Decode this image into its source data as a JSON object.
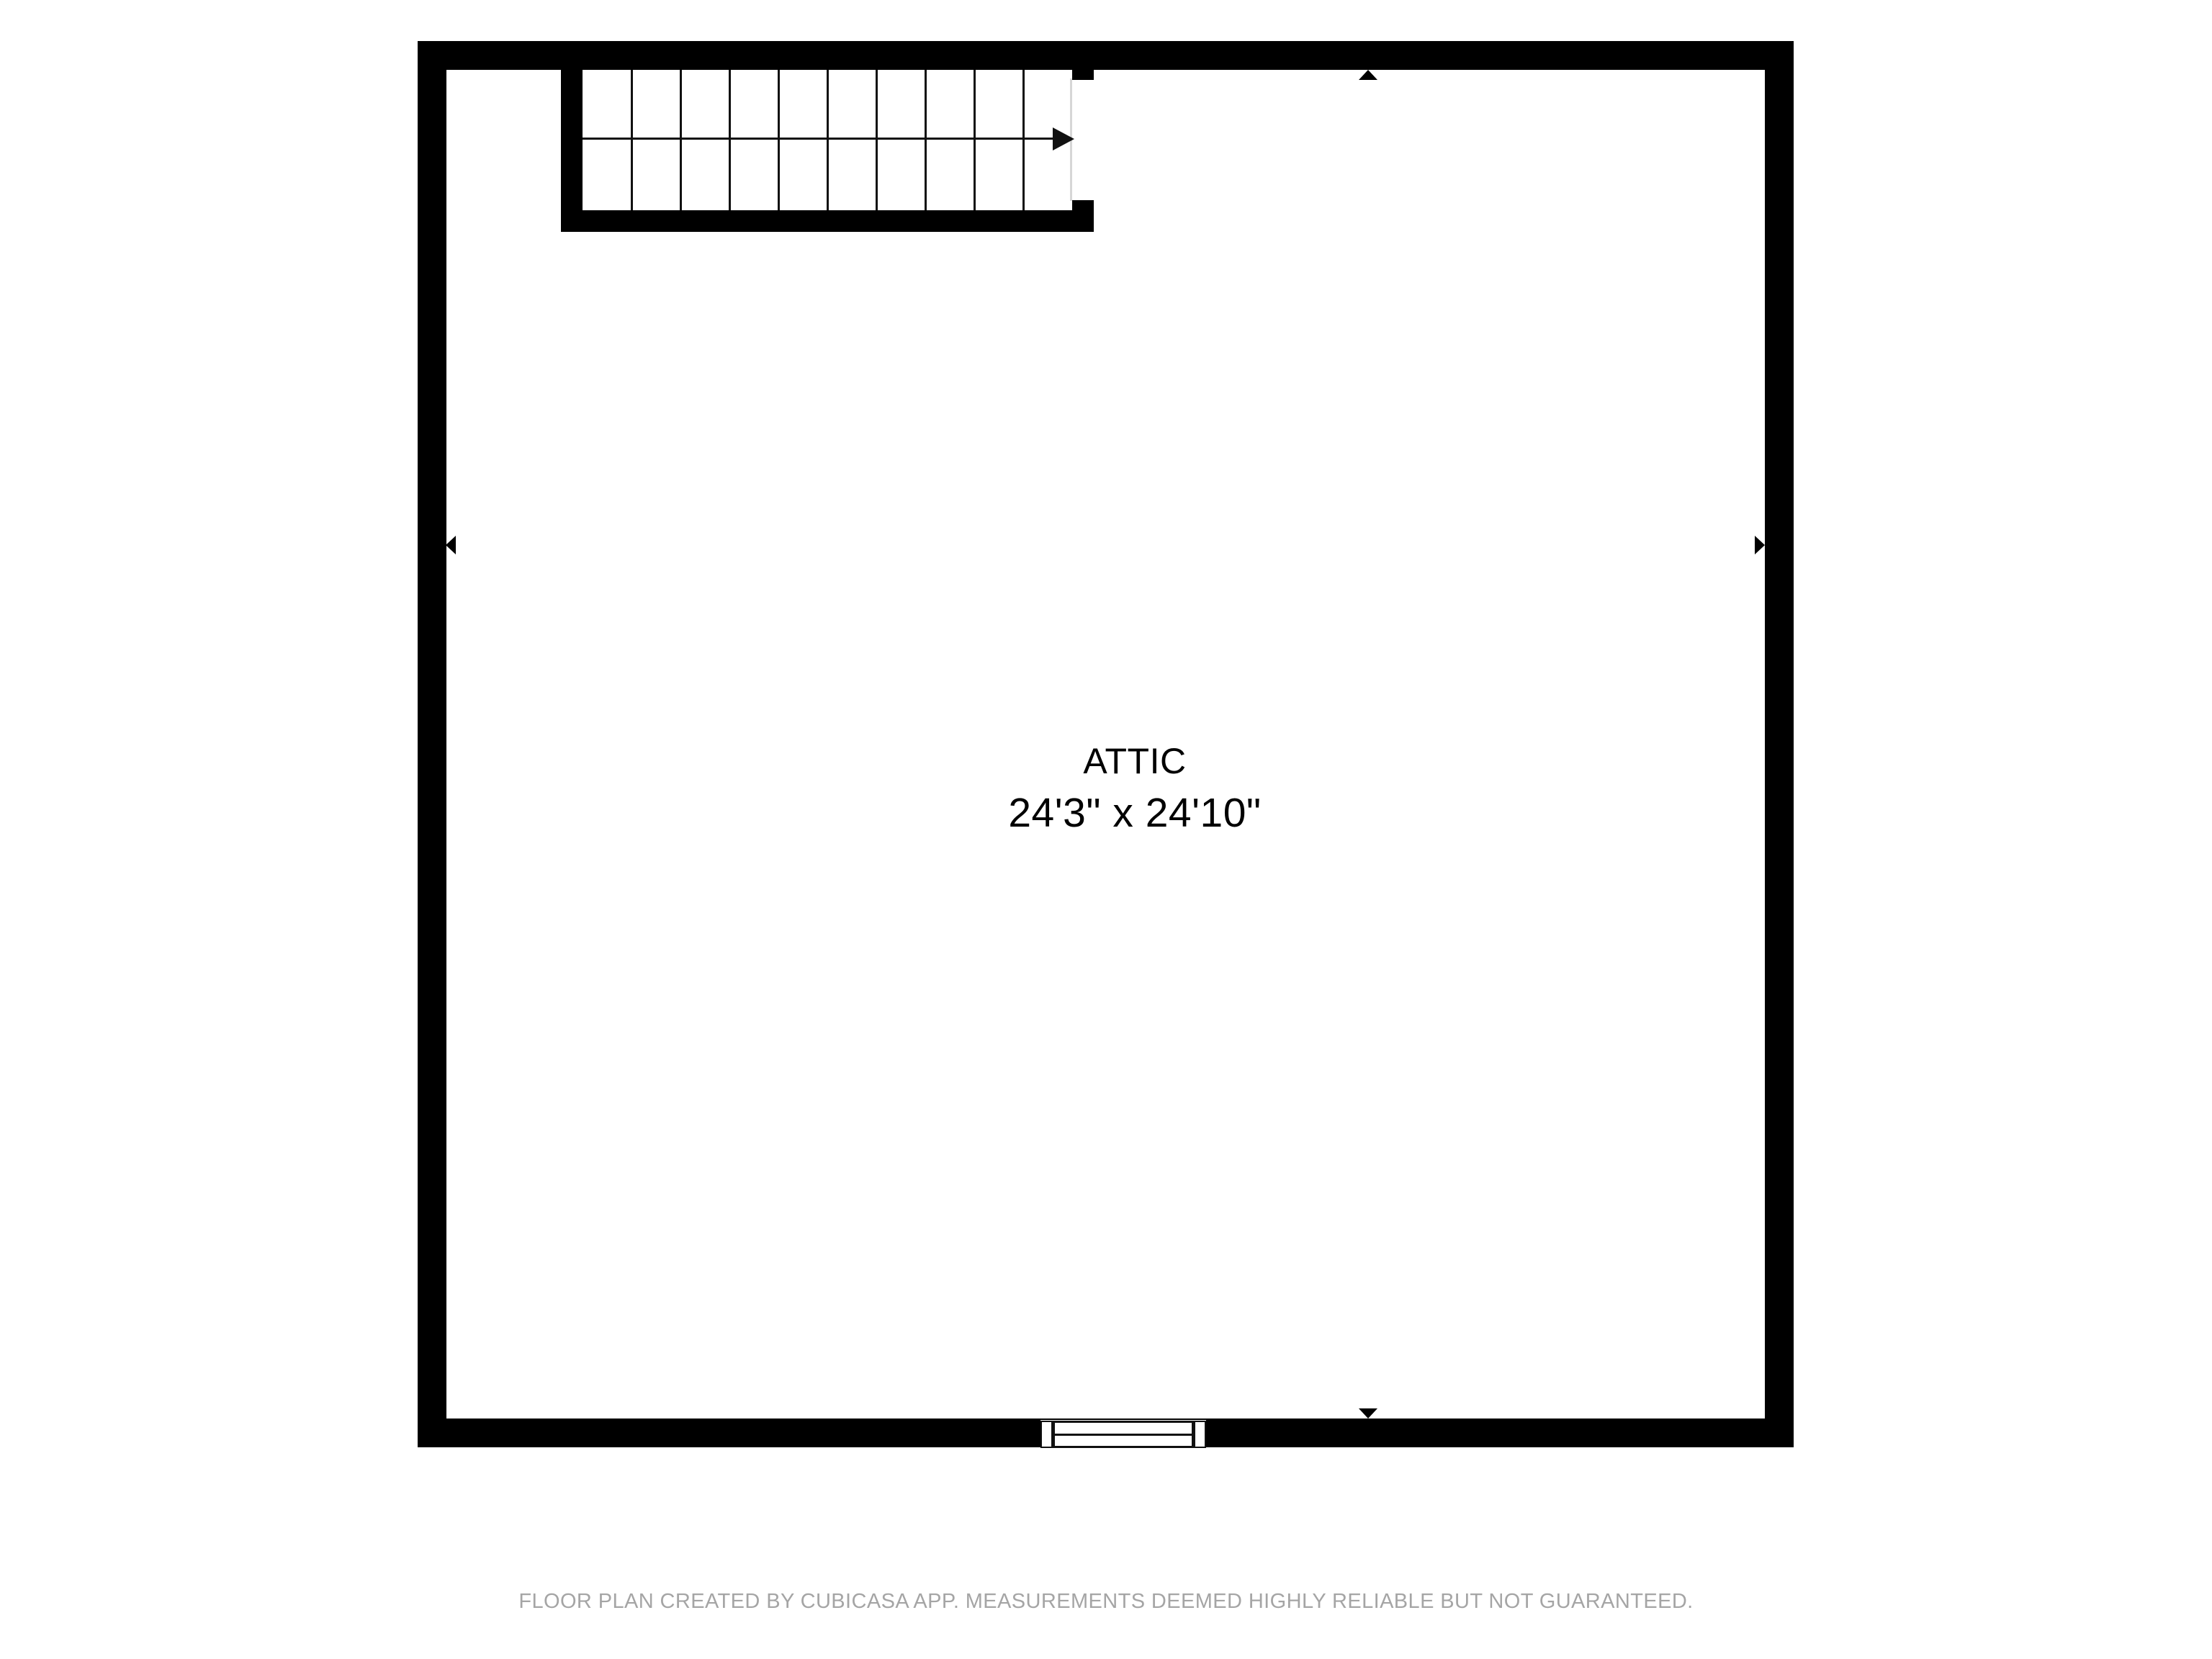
{
  "room": {
    "name": "ATTIC",
    "dimensions": "24'3\" x 24'10\""
  },
  "stairs": {
    "tread_count": 10,
    "direction": "right",
    "arrow_icon": "right-arrow"
  },
  "window": {
    "symbol": "double-hung-window"
  },
  "markers": {
    "top": "up-triangle-marker",
    "bottom": "down-triangle-marker",
    "left": "left-triangle-marker",
    "right": "right-triangle-marker"
  },
  "footer": {
    "disclaimer": "FLOOR PLAN CREATED BY CUBICASA APP. MEASUREMENTS DEEMED HIGHLY RELIABLE BUT NOT GUARANTEED."
  },
  "colors": {
    "wall": "#000000",
    "line": "#111111",
    "stair_edge": "#d6d6d6",
    "footer_text": "#a5a5a5",
    "room_text": "#000000",
    "background": "#ffffff"
  }
}
